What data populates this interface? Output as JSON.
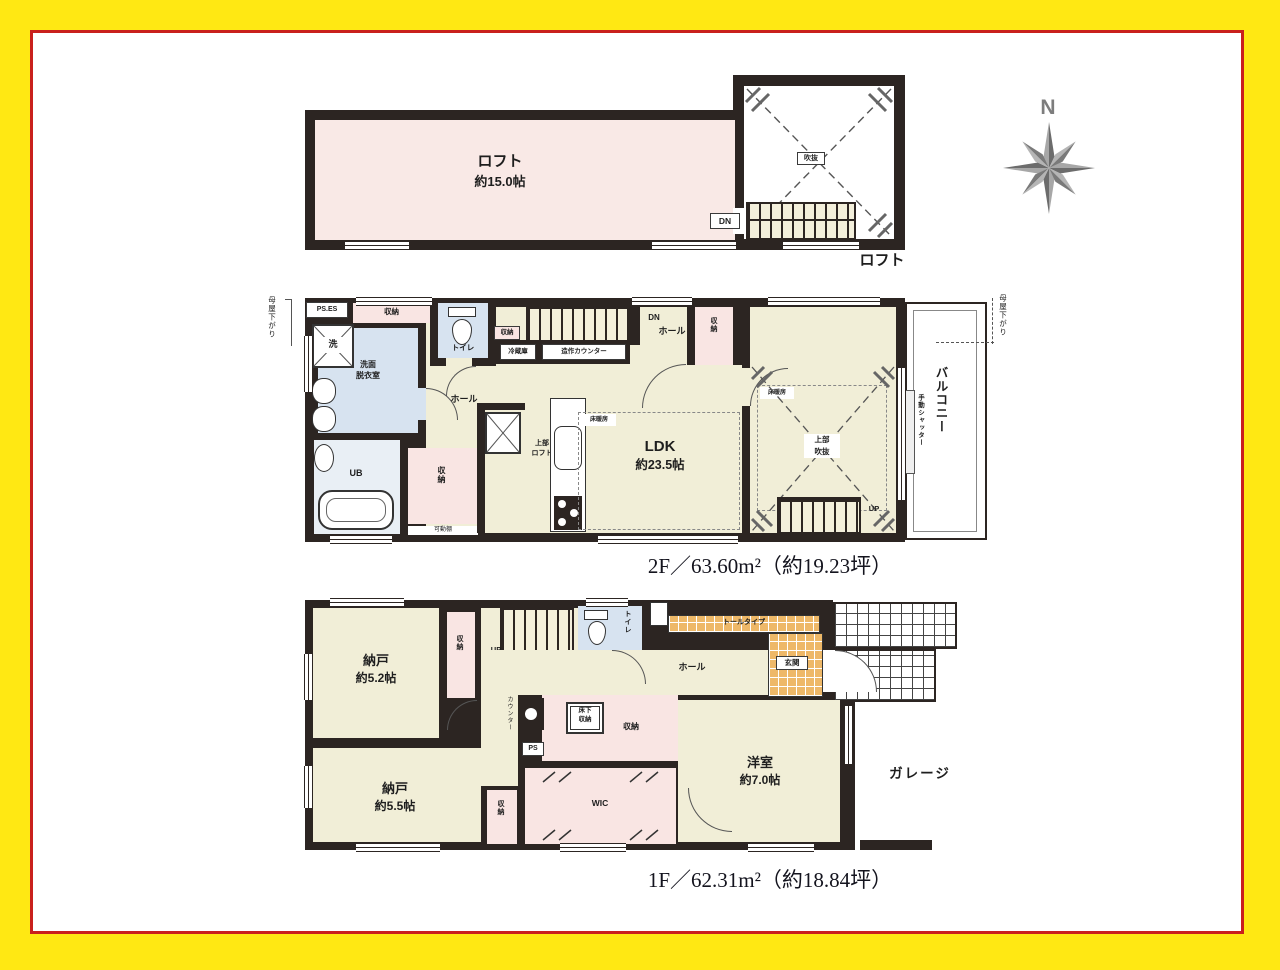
{
  "colors": {
    "frame_yellow": "#ffe813",
    "frame_red": "#c9201d",
    "wall": "#2c2522",
    "cream": "#f1eed7",
    "pink": "#f9e5e3",
    "blue": "#d7e3f0",
    "bath_blue": "#e9eff5",
    "orange": "#eeb868",
    "compass_gray": "#7d7d7d"
  },
  "compass": {
    "north_label": "N"
  },
  "loft": {
    "name_label": "ロフト",
    "size_label": "約15.0帖",
    "void_label": "吹抜",
    "stairs_down_label": "DN",
    "floor_tag": "ロフト"
  },
  "floor2": {
    "caption": "2F／63.60m²（約19.23坪）",
    "ps_es": "PS.ES",
    "closet_top": "収納",
    "washer": "洗",
    "washroom_line1": "洗面",
    "washroom_line2": "脱衣室",
    "toilet": "トイレ",
    "closet_small": "収納",
    "stairs_down": "DN",
    "hall_upper": "ホール",
    "hall_lower": "ホール",
    "fridge": "冷蔵庫",
    "counter": "造作カウンター",
    "closet_hall": "収納",
    "loft_above_line1": "上部",
    "loft_above_line2": "ロフト",
    "closet_mid": "収納",
    "shelf": "可動棚",
    "bath": "UB",
    "ldk_line1": "LDK",
    "ldk_line2": "約23.5帖",
    "floor_heating_ldk": "床暖房",
    "floor_heating_bed": "床暖房",
    "void_above_line1": "上部",
    "void_above_line2": "吹抜",
    "stairs_up": "UP",
    "balcony": "バルコニー",
    "shutter": "手動シャッター",
    "roof_slope_left": "母屋下がり",
    "roof_slope_right": "母屋下がり"
  },
  "floor1": {
    "caption": "1F／62.31m²（約18.84坪）",
    "storage52_line1": "納戸",
    "storage52_line2": "約5.2帖",
    "closet_a": "収納",
    "stairs_up": "UP",
    "void_above_line1": "上部",
    "void_above_line2": "吹抜",
    "toilet": "トイレ",
    "hall": "ホール",
    "shoe_cabinet": "トールタイプ",
    "entrance": "玄関",
    "underfloor_line1": "床下",
    "underfloor_line2": "収納",
    "closet_b": "収納",
    "counter_v": "カウンター",
    "ps": "PS",
    "wic": "WIC",
    "storage55_line1": "納戸",
    "storage55_line2": "約5.5帖",
    "closet_c": "収納",
    "western_line1": "洋室",
    "western_line2": "約7.0帖",
    "garage": "ガレージ"
  }
}
